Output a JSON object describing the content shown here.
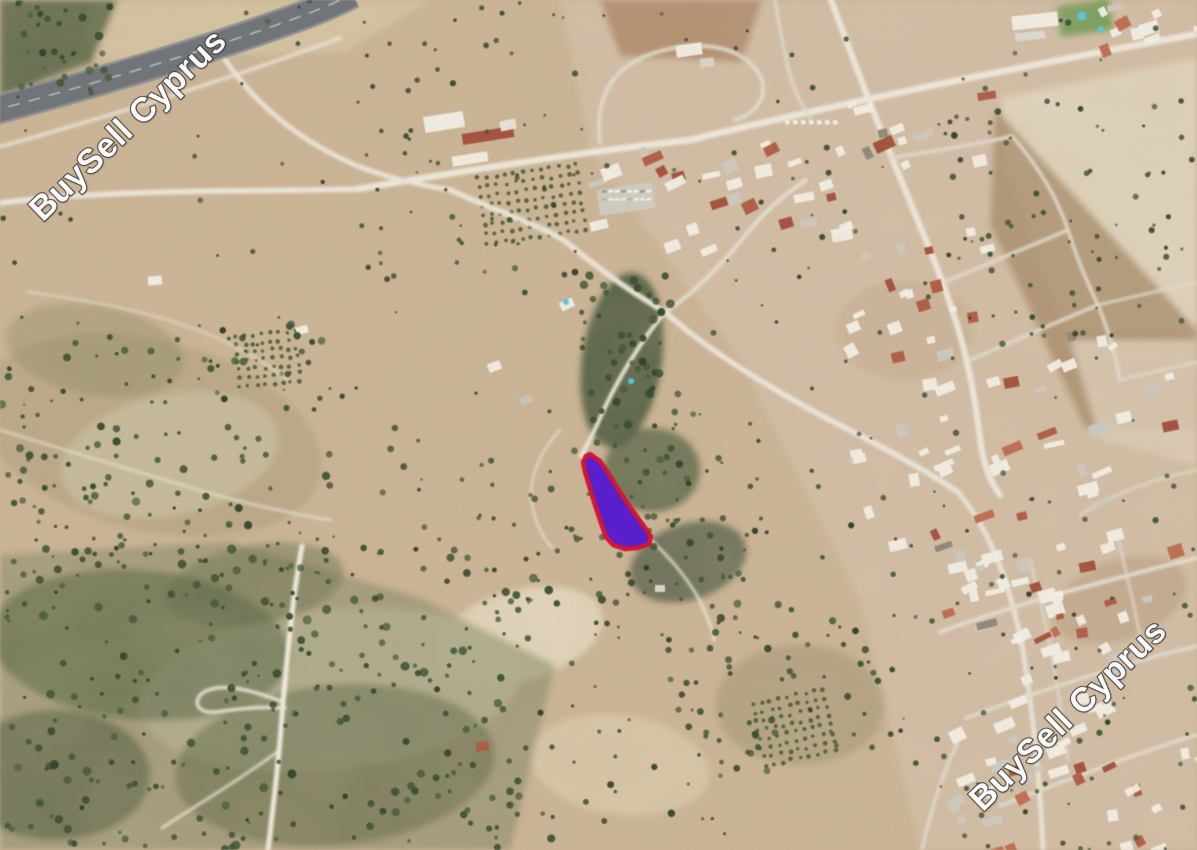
{
  "watermarks": {
    "text": "BuySell Cyprus",
    "text_color": "#ffffff",
    "outline_color": "#3b3b3b"
  },
  "highlighted_plot": {
    "fill": "#5a1ed2",
    "stroke": "#d8152f",
    "stroke_width": 4.5,
    "points": "590,454 600,461 609,474 618,489 628,504 638,518 646,529 651,537 649,544 638,548 625,549 613,545 606,537 602,526 596,508 590,489 585,472 583,462 586,456"
  },
  "palette": {
    "terrain_base": "#cdb494",
    "field_light": "#e1d4bb",
    "urban_ground": "#d6c1a9",
    "vegetation_dark": "#46563a",
    "road_light": "#e9e4d6",
    "highway": "#6f7276",
    "roof_red": "#b05a40",
    "building_white": "#f1ede3",
    "pool_blue": "#4fc8e0"
  }
}
